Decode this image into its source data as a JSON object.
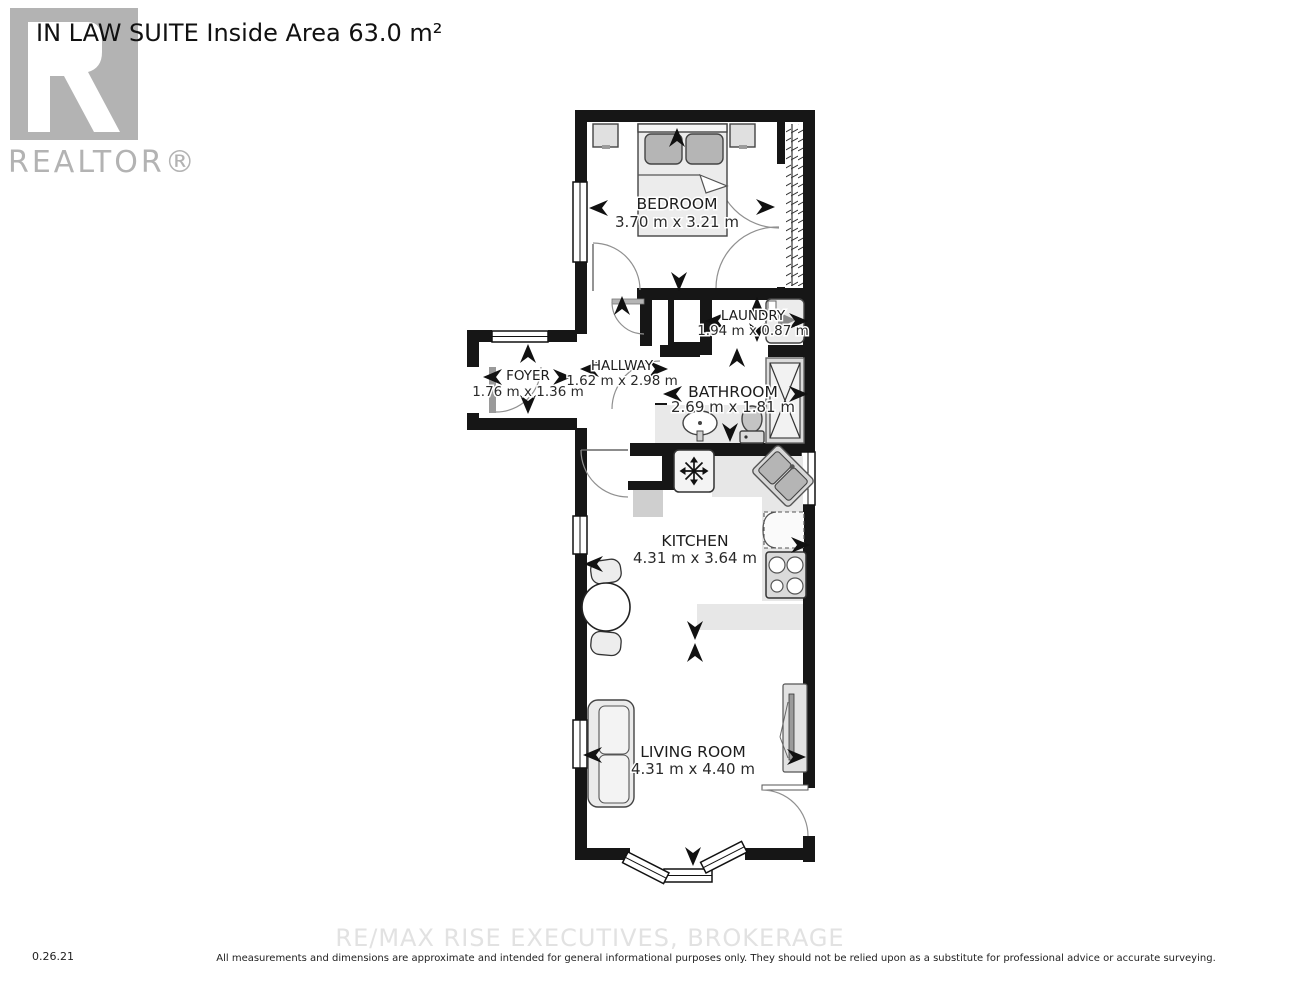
{
  "title": "IN LAW SUITE Inside Area 63.0 m²",
  "logo": {
    "brand": "REALTOR®"
  },
  "rooms": {
    "bedroom": {
      "name": "BEDROOM",
      "dims": "3.70 m x 3.21 m"
    },
    "laundry": {
      "name": "LAUNDRY",
      "dims": "1.94 m x 0.87 m"
    },
    "hallway": {
      "name": "HALLWAY",
      "dims": "1.62 m x 2.98 m"
    },
    "foyer": {
      "name": "FOYER",
      "dims": "1.76 m x 1.36 m"
    },
    "bathroom": {
      "name": "BATHROOM",
      "dims": "2.69 m x 1.81 m"
    },
    "kitchen": {
      "name": "KITCHEN",
      "dims": "4.31 m x 3.64 m"
    },
    "living_room": {
      "name": "LIVING ROOM",
      "dims": "4.31 m x 4.40 m"
    }
  },
  "footer": {
    "date_code": "0.26.21",
    "watermark": "RE/MAX RISE EXECUTIVES, BROKERAGE",
    "disclaimer": "All measurements and dimensions are approximate and intended for general informational purposes only. They should not be relied upon as a substitute for professional advice or accurate surveying."
  },
  "colors": {
    "wall": "#161616",
    "logo_gray": "#b3b3b3",
    "watermark_gray": "#e2e2e2"
  }
}
